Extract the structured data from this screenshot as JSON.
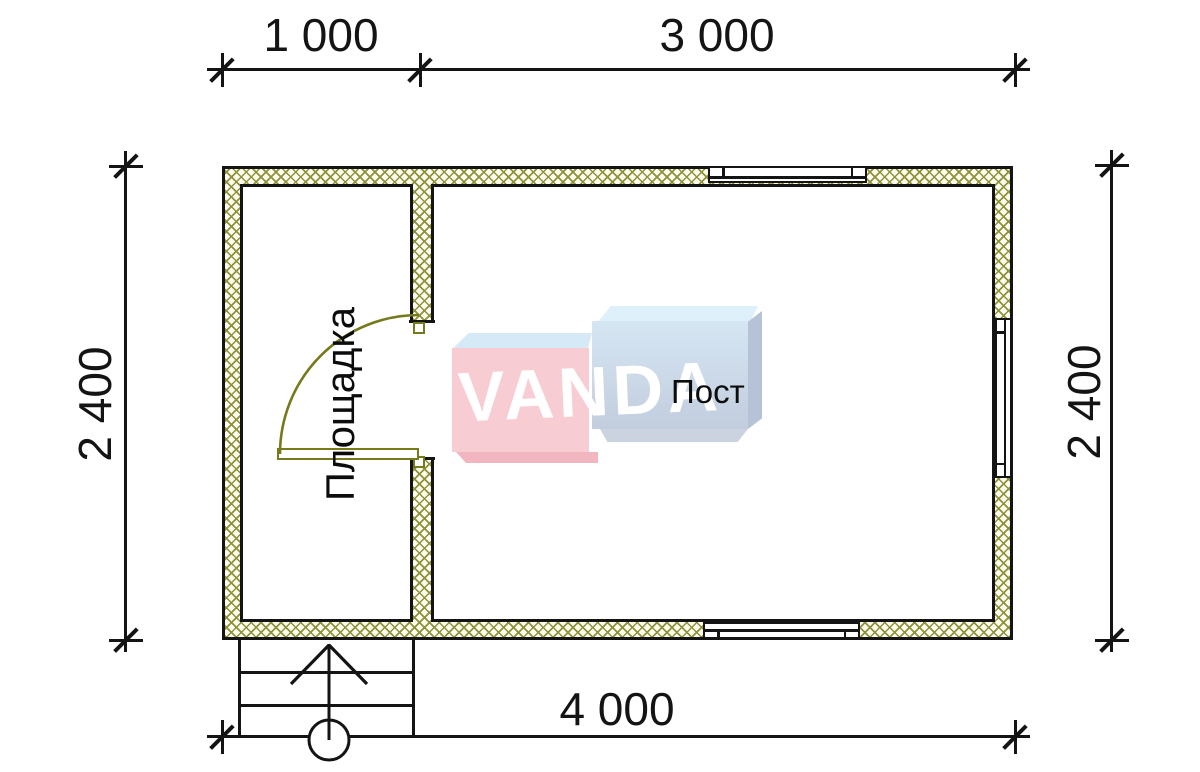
{
  "drawing_type": "floor-plan",
  "dimensions": {
    "top_left_segment": "1 000",
    "top_right_segment": "3 000",
    "left_height": "2 400",
    "right_height": "2 400",
    "bottom_total": "4 000"
  },
  "rooms": {
    "left_label": "Площадка",
    "right_label": "Пост"
  },
  "watermark": {
    "text": "VANDA"
  },
  "colors": {
    "wall_hatch": "#8f923a",
    "door": "#767a1c",
    "line": "#141414",
    "watermark_pink": "#f8ccd3",
    "watermark_blue": "#cfe2f1"
  }
}
